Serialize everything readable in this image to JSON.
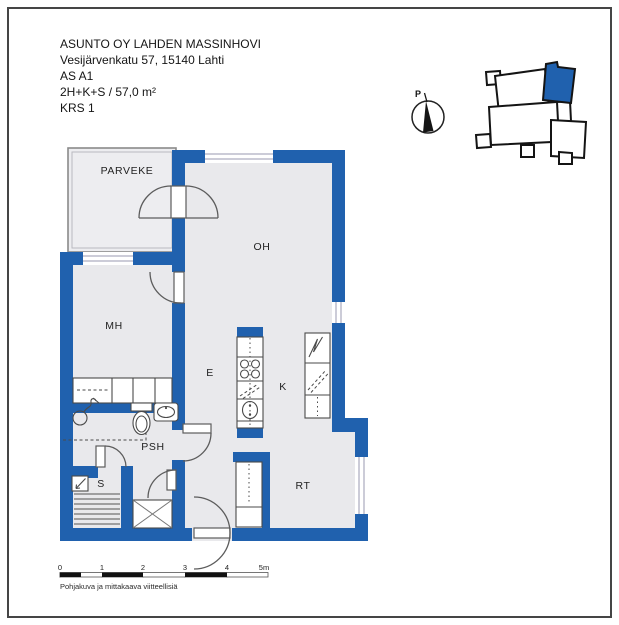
{
  "document": {
    "building": "ASUNTO OY LAHDEN MASSINHOVI",
    "address": "Vesijärvenkatu 57, 15140 Lahti",
    "apartment": "AS A1",
    "layout": "2H+K+S / 57,0 m²",
    "floor": "KRS 1"
  },
  "compass": {
    "north_label": "P"
  },
  "rooms": {
    "balcony": "PARVEKE",
    "living_room": "OH",
    "bedroom": "MH",
    "hallway": "E",
    "kitchen": "K",
    "washroom": "PSH",
    "sauna": "S",
    "utility_room": "RT"
  },
  "scale_bar": {
    "ticks": [
      "0",
      "1",
      "2",
      "3",
      "4"
    ],
    "end_label": "5m"
  },
  "caption": "Pohjakuva ja mittakaava viitteellisiä",
  "colors": {
    "wall_blue": "#2061ae",
    "floor_gray": "#e9e9ec",
    "site_highlight": "#2061ae"
  }
}
